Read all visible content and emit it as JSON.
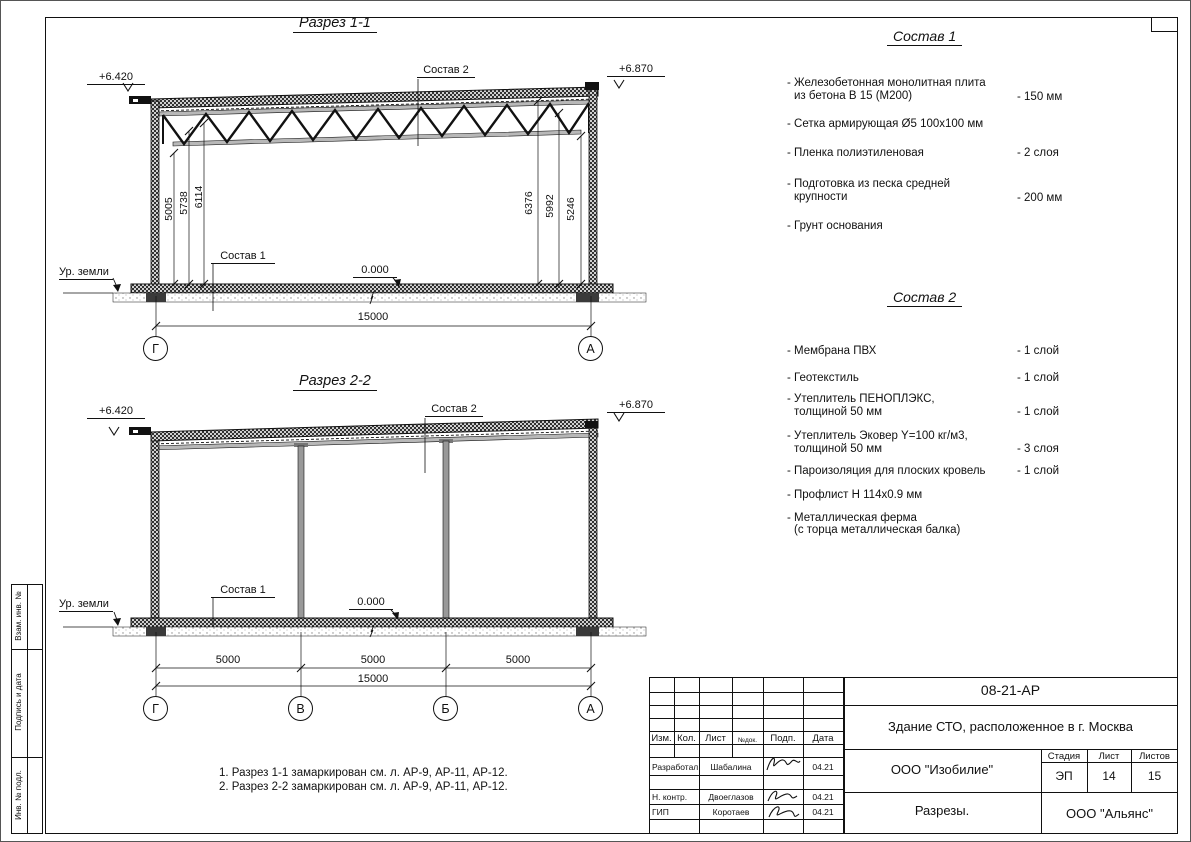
{
  "sections": {
    "razrez1": {
      "title": "Разрез 1-1",
      "elev_left": "+6.420",
      "elev_right": "+6.870",
      "label_sostav2": "Состав 2",
      "label_sostav1": "Состав 1",
      "level_zero": "0.000",
      "ground_label": "Ур. земли",
      "dims_left": [
        "5005",
        "5738",
        "6114"
      ],
      "dims_right": [
        "6376",
        "5992",
        "5246"
      ],
      "dim_total": "15000",
      "grid_marks": [
        "Г",
        "А"
      ]
    },
    "razrez2": {
      "title": "Разрез 2-2",
      "elev_left": "+6.420",
      "elev_right": "+6.870",
      "label_sostav2": "Состав 2",
      "label_sostav1": "Состав 1",
      "level_zero": "0.000",
      "ground_label": "Ур. земли",
      "dims_bays": [
        "5000",
        "5000",
        "5000"
      ],
      "dim_total": "15000",
      "grid_marks": [
        "Г",
        "В",
        "Б",
        "А"
      ]
    }
  },
  "sostav1": {
    "title": "Состав 1",
    "items": [
      {
        "line1": "- Железобетонная  монолитная плита",
        "line2": "из бетона В 15 (М200)",
        "value": "- 150 мм"
      },
      {
        "line1": "- Сетка армирующая Ø5 100x100 мм",
        "line2": "",
        "value": ""
      },
      {
        "line1": "- Пленка полиэтиленовая",
        "line2": "",
        "value": "-  2 слоя"
      },
      {
        "line1": "- Подготовка из песка средней",
        "line2": "крупности",
        "value": "- 200 мм"
      },
      {
        "line1": "- Грунт основания",
        "line2": "",
        "value": ""
      }
    ]
  },
  "sostav2": {
    "title": "Состав 2",
    "items": [
      {
        "line1": "- Мембрана ПВХ",
        "line2": "",
        "value": "- 1 слой"
      },
      {
        "line1": "- Геотекстиль",
        "line2": "",
        "value": "- 1 слой"
      },
      {
        "line1": "- Утеплитель ПЕНОПЛЭКС,",
        "line2": "толщиной 50 мм",
        "value": "- 1 слой"
      },
      {
        "line1": "- Утеплитель Эковер Y=100 кг/м3,",
        "line2": "толщиной 50 мм",
        "value": "- 3 слоя"
      },
      {
        "line1": "- Пароизоляция для плоских кровель",
        "line2": "",
        "value": "- 1 слой"
      },
      {
        "line1": "- Профлист Н 114x0.9 мм",
        "line2": "",
        "value": ""
      },
      {
        "line1": "- Металлическая ферма",
        "line2": "(с торца металлическая балка)",
        "value": ""
      }
    ]
  },
  "notes": [
    "1. Разрез 1-1 замаркирован см. л. АР-9, АР-11, АР-12.",
    "2. Разрез 2-2 замаркирован см. л. АР-9, АР-11, АР-12."
  ],
  "side_strip": [
    "Взам. инв. №",
    "Подпись и дата",
    "Инв. № подл."
  ],
  "titleblock": {
    "doc_number": "08-21-АР",
    "project_title": "Здание СТО, расположенное в г. Москва",
    "header_cols": [
      "Изм.",
      "Кол.",
      "Лист",
      "№док.",
      "Подп.",
      "Дата"
    ],
    "rows": [
      {
        "role": "Разработал",
        "name": "Шабалина",
        "date": "04.21"
      },
      {
        "role": "Н. контр.",
        "name": "Двоеглазов",
        "date": "04.21"
      },
      {
        "role": "ГИП",
        "name": "Коротаев",
        "date": "04.21"
      }
    ],
    "company": "ООО \"Изобилие\"",
    "sheet_title": "Разрезы.",
    "stage_label": "Стадия",
    "sheet_label": "Лист",
    "sheets_label": "Листов",
    "stage": "ЭП",
    "sheet_num": "14",
    "sheets_total": "15",
    "contractor": "ООО \"Альянс\""
  }
}
